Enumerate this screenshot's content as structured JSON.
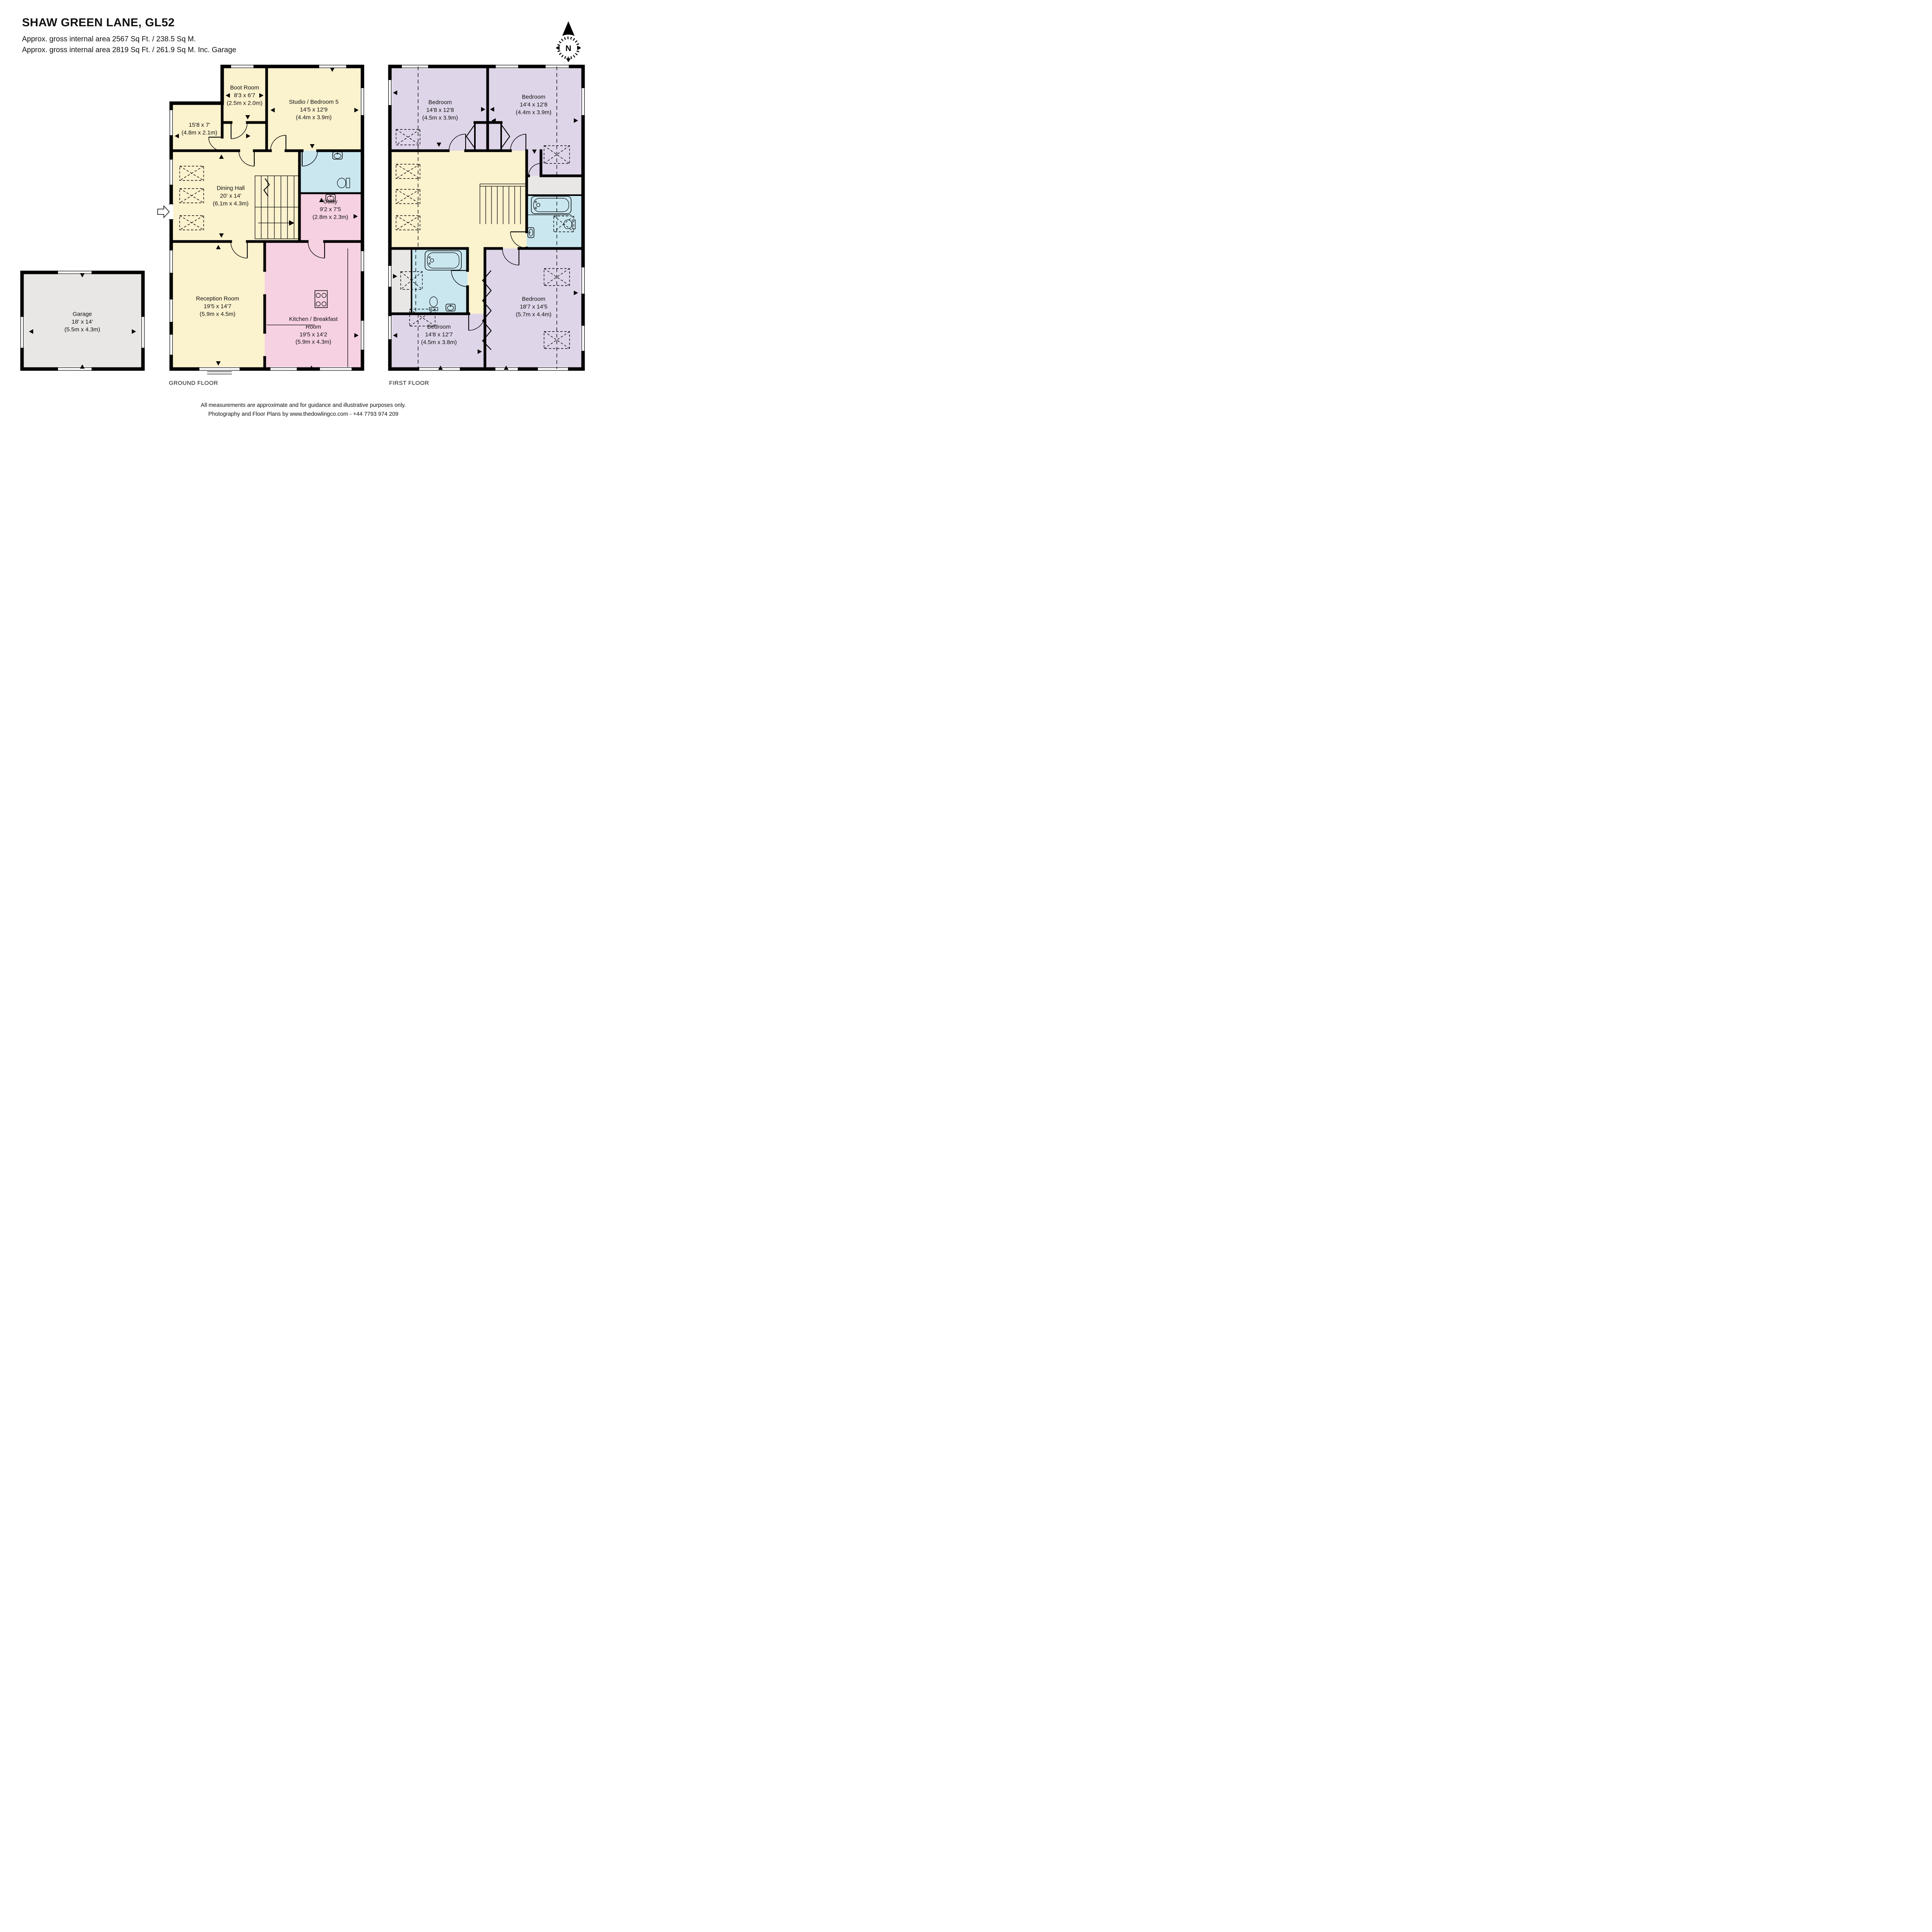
{
  "header": {
    "title": "SHAW GREEN LANE, GL52",
    "subtitle1": "Approx. gross internal area 2567 Sq Ft. / 238.5 Sq M.",
    "subtitle2": "Approx. gross internal area 2819 Sq Ft. / 261.9 Sq M. Inc. Garage"
  },
  "compass": {
    "label": "N"
  },
  "floors": {
    "ground": {
      "label": "GROUND FLOOR",
      "rooms": {
        "boot_room": {
          "name": "Boot Room",
          "imperial": "8'3 x 6'7",
          "metric": "(2.5m x 2.0m)"
        },
        "studio": {
          "name": "Studio / Bedroom 5",
          "imperial": "14'5 x 12'9",
          "metric": "(4.4m x 3.9m)"
        },
        "hallway": {
          "imperial": "15'8 x 7'",
          "metric": "(4.8m x 2.1m)"
        },
        "dining_hall": {
          "name": "Dining Hall",
          "imperial": "20' x 14'",
          "metric": "(6.1m x 4.3m)"
        },
        "utility": {
          "name": "Utility",
          "imperial": "9'2 x 7'5",
          "metric": "(2.8m x 2.3m)"
        },
        "reception": {
          "name": "Reception Room",
          "imperial": "19'5 x 14'7",
          "metric": "(5.9m x 4.5m)"
        },
        "kitchen": {
          "name": "Kitchen / Breakfast Room",
          "imperial": "19'5 x 14'2",
          "metric": "(5.9m x 4.3m)"
        },
        "garage": {
          "name": "Garage",
          "imperial": "18' x 14'",
          "metric": "(5.5m x 4.3m)"
        }
      }
    },
    "first": {
      "label": "FIRST FLOOR",
      "rooms": {
        "bedroom_top_left": {
          "name": "Bedroom",
          "imperial": "14'8 x 12'8",
          "metric": "(4.5m x 3.9m)"
        },
        "bedroom_top_right": {
          "name": "Bedroom",
          "imperial": "14'4 x 12'8",
          "metric": "(4.4m x 3.9m)"
        },
        "bedroom_bottom_right": {
          "name": "Bedroom",
          "imperial": "18'7 x 14'5",
          "metric": "(5.7m x 4.4m)"
        },
        "bedroom_bottom_left": {
          "name": "Bedroom",
          "imperial": "14'8 x 12'7",
          "metric": "(4.5m x 3.8m)"
        }
      }
    }
  },
  "footer": {
    "line1": "All measurements are approximate and for guidance and illustrative purposes only.",
    "line2": "Photography and Floor Plans by www.thedowlingco.com - +44 7793 974 209"
  },
  "palette": {
    "room_yellow": "#FBF2CE",
    "room_pink": "#F6D1E2",
    "room_blue": "#CAE7F0",
    "room_purple": "#DFD5E9",
    "room_gray": "#E8E7E5",
    "wall": "#000000"
  }
}
